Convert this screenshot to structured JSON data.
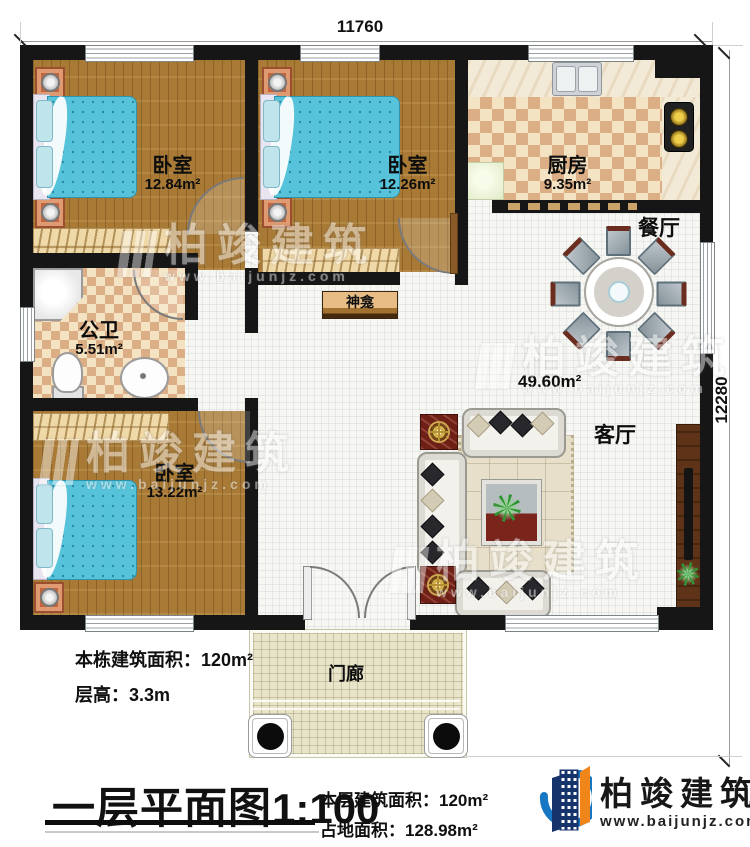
{
  "plan": {
    "dim_width": "11760",
    "dim_height": "12280"
  },
  "rooms": {
    "bedroom1": {
      "name": "卧室",
      "area": "12.84m²"
    },
    "bedroom2": {
      "name": "卧室",
      "area": "12.26m²"
    },
    "bedroom3": {
      "name": "卧室",
      "area": "13.22m²"
    },
    "kitchen": {
      "name": "厨房",
      "area": "9.35m²"
    },
    "bathroom": {
      "name": "公卫",
      "area": "5.51m²"
    },
    "dining": {
      "name": "餐厅"
    },
    "living": {
      "name": "客厅",
      "area": "49.60m²"
    },
    "porch": {
      "name": "门廊"
    },
    "shrine": {
      "name": "神龛"
    }
  },
  "notes": {
    "building_area": "本栋建筑面积：120m²",
    "floor_height": "层高：3.3m"
  },
  "titleblock": {
    "title": "一层平面图",
    "scale": "1:100",
    "floor_area": "本层建筑面积：120m²",
    "land_area": "占地面积：128.98m²"
  },
  "brand": {
    "name": "柏竣建筑",
    "site": "www.baijunjz.com"
  },
  "watermark": {
    "name": "柏竣建筑",
    "site": "www.baijunjz.com"
  },
  "colors": {
    "wall": "#161616",
    "wood": "#a87a36",
    "mattress": "#57c3da",
    "accent_red": "#6e1f16",
    "brand_blue": "#1877c2",
    "brand_navy": "#16336b",
    "brand_orange": "#f08519"
  }
}
